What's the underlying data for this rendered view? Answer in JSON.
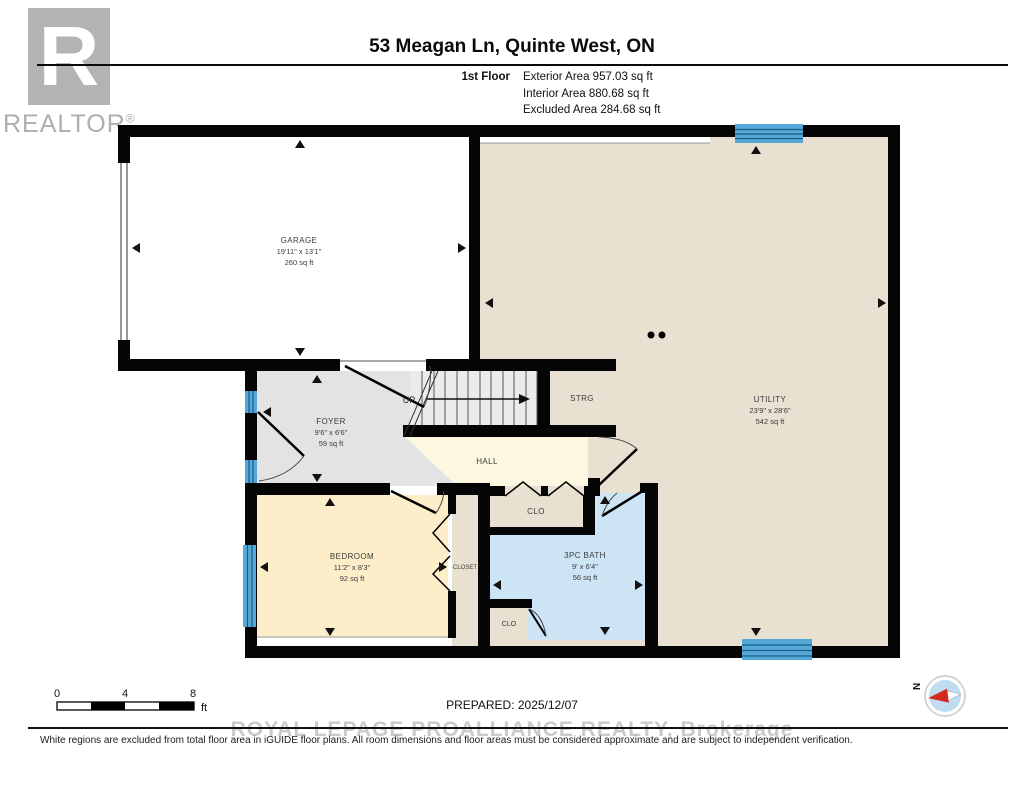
{
  "header": {
    "logo_letter": "R",
    "logo_text": "REALTOR",
    "logo_reg": "®",
    "title": "53 Meagan Ln, Quinte West, ON",
    "floor_label": "1st Floor",
    "areas": [
      "Exterior Area 957.03 sq ft",
      "Interior Area 880.68 sq ft",
      "Excluded Area 284.68 sq ft"
    ]
  },
  "rooms": {
    "garage": {
      "name": "GARAGE",
      "dims": "19'11\" x 13'1\"",
      "area": "260 sq ft"
    },
    "utility": {
      "name": "UTILITY",
      "dims": "23'9\" x 28'6\"",
      "area": "542 sq ft"
    },
    "foyer": {
      "name": "FOYER",
      "dims": "9'6\" x 6'6\"",
      "area": "59 sq ft"
    },
    "strg": {
      "name": "STRG"
    },
    "stairs": {
      "label": "UP"
    },
    "hall": {
      "name": "HALL"
    },
    "clo_hall": {
      "name": "CLO"
    },
    "closet": {
      "name": "CLOSET"
    },
    "bedroom": {
      "name": "BEDROOM",
      "dims": "11'2\" x 8'3\"",
      "area": "92 sq ft"
    },
    "bath": {
      "name": "3PC BATH",
      "dims": "9' x 6'4\"",
      "area": "56 sq ft"
    },
    "clo_bath": {
      "name": "CLO"
    }
  },
  "footer": {
    "scale_ticks": [
      "0",
      "4",
      "8"
    ],
    "scale_unit": "ft",
    "prepared": "PREPARED: 2025/12/07",
    "compass_n": "N",
    "watermark": "ROYAL LEPAGE PROALLIANCE REALTY, Brokerage",
    "disclaimer": "White regions are excluded from total floor area in iGUIDE floor plans. All room dimensions and floor areas must be considered approximate and are subject to independent verification."
  },
  "colors": {
    "wall": "#050505",
    "utility_floor": "#e8e0d0",
    "hall_floor": "#fcf7e1",
    "bedroom_floor": "#fdeec9",
    "bath_floor": "#cde4f5",
    "foyer_floor": "#e3e3e3",
    "stairs_floor": "#ebebeb",
    "window_blue": "#54a9d8",
    "window_line": "#1d5c85",
    "logo_gray": "#b3b3b3",
    "watermark_gray": "#cbcbcb",
    "compass_red": "#d42a1e",
    "compass_blue": "#bfdcf0"
  }
}
